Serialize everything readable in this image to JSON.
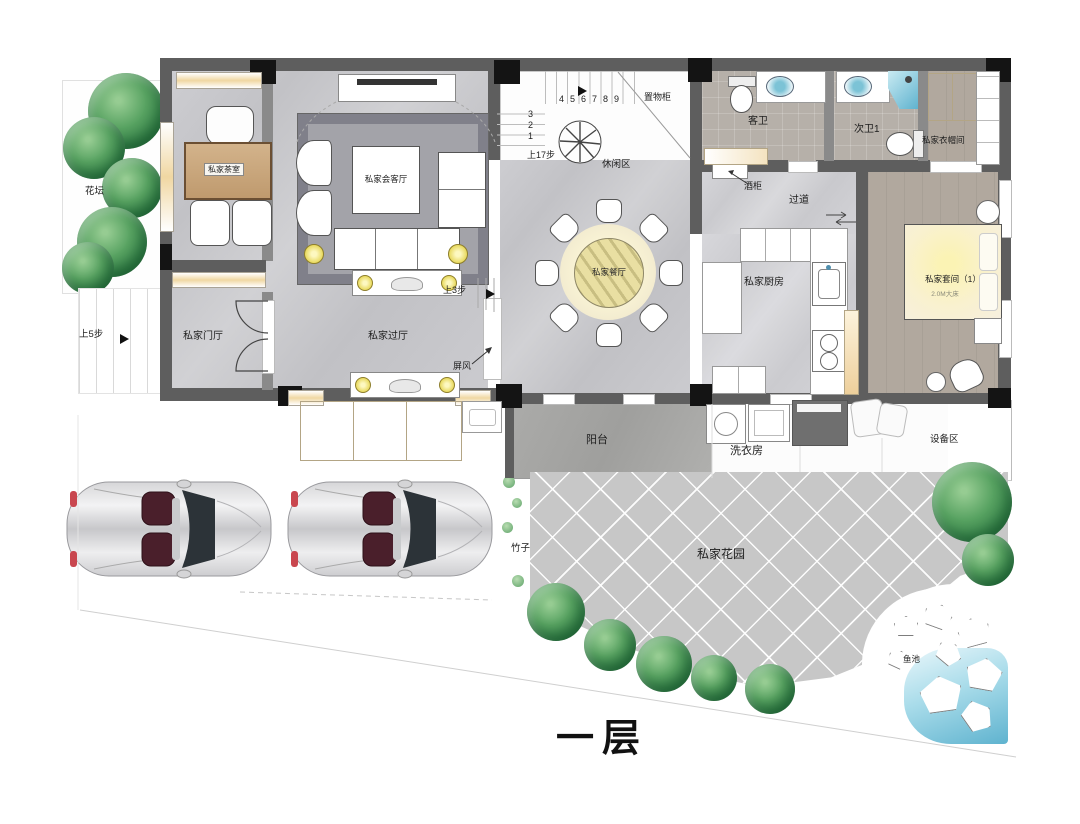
{
  "title": "一层",
  "rooms": {
    "flower_bed": "花坛",
    "tea_room": "私家茶室",
    "reception": "私家会客厅",
    "dining": "私家餐厅",
    "kitchen": "私家厨房",
    "entry_hall": "私家门厅",
    "foyer": "私家过厅",
    "guest_bath": "客卫",
    "second_bath": "次卫1",
    "cloakroom": "私家衣帽间",
    "suite": "私家套间（1）",
    "suite_note": "2.0M大床",
    "corridor": "过道",
    "wine_cabinet": "酒柜",
    "leisure_area": "休闲区",
    "storage_cabinet": "置物柜",
    "screen": "屏风",
    "balcony": "阳台",
    "laundry": "洗衣房",
    "equipment": "设备区",
    "garden": "私家花园",
    "bamboo": "竹子",
    "fish_pond": "鱼池"
  },
  "annotations": {
    "up5": "上5步",
    "up3": "上3步",
    "up17": "上17步"
  },
  "stairs": {
    "top": [
      "4",
      "5",
      "6",
      "7",
      "8",
      "9"
    ],
    "side": [
      "3",
      "2",
      "1"
    ]
  },
  "colors": {
    "wall": "#5e5e5e",
    "window_wood": "#f0d7a2",
    "lamp": "#e8d95e",
    "water": "#5fb3cf",
    "tree": "#36834b"
  }
}
